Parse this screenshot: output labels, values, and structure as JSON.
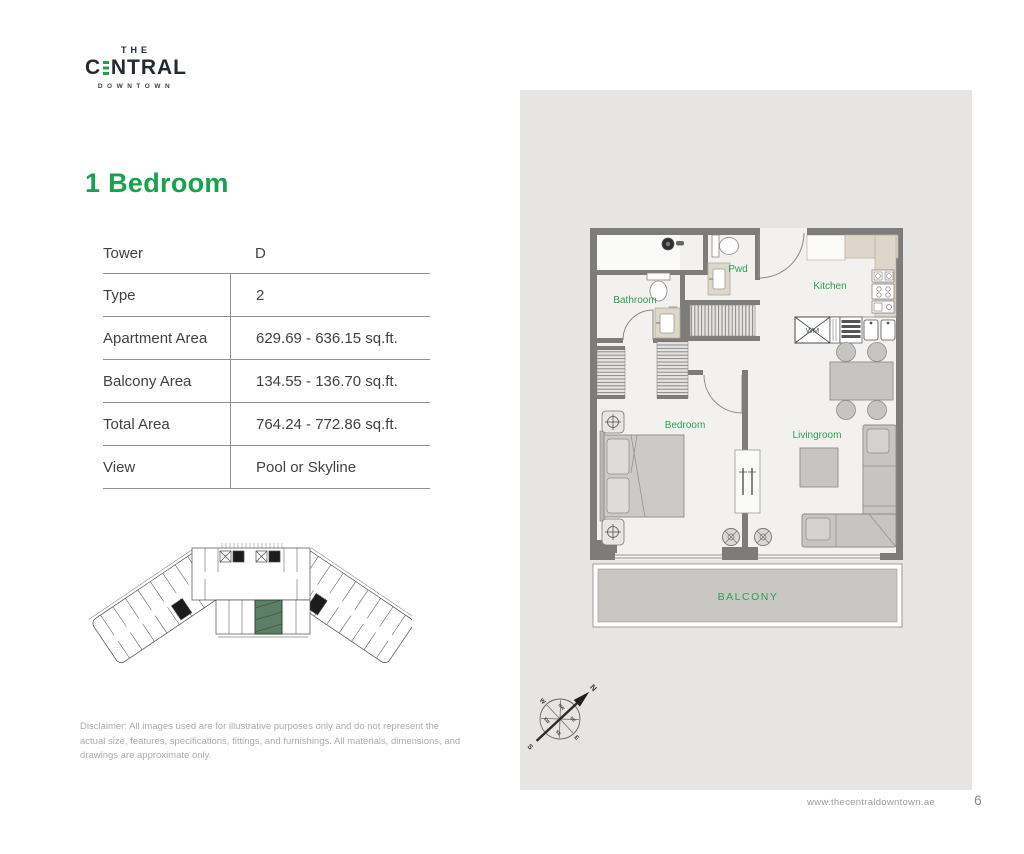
{
  "logo": {
    "the": "THE",
    "c": "C",
    "ntral": "NTRAL",
    "downtown": "DOWNTOWN"
  },
  "heading": "1 Bedroom",
  "spec_table": {
    "rows": [
      {
        "label": "Tower",
        "value": "D"
      },
      {
        "label": "Type",
        "value": "2"
      },
      {
        "label": "Apartment Area",
        "value": "629.69 - 636.15 sq.ft."
      },
      {
        "label": "Balcony Area",
        "value": "134.55 - 136.70 sq.ft."
      },
      {
        "label": "Total Area",
        "value": "764.24 - 772.86 sq.ft."
      },
      {
        "label": "View",
        "value": "Pool or Skyline"
      }
    ]
  },
  "floorplan": {
    "labels": {
      "bathroom": "Bathroom",
      "pwd": "Pwd",
      "kitchen": "Kitchen",
      "wm": "WM",
      "bedroom": "Bedroom",
      "livingroom": "Livingroom",
      "balcony": "BALCONY"
    }
  },
  "compass": {
    "n": "N",
    "s": "S",
    "e": "E",
    "w": "W",
    "ne": "NE",
    "nw": "NW",
    "se": "SE",
    "sw": "SW"
  },
  "disclaimer": "Disclaimer: All images used are for illustrative purposes only and do not represent the actual size, features, specifications, fittings, and furnishings. All materials, dimensions, and drawings are approximate only.",
  "footer": {
    "website": "www.thecentraldowntown.ae",
    "page_number": "6"
  },
  "colors": {
    "brand_green": "#21a14f",
    "label_green": "#2f9e53",
    "wall_gray": "#7e7c7a",
    "panel_bg": "#e7e5e3",
    "keyplan_unit_green": "#5d7f68"
  }
}
